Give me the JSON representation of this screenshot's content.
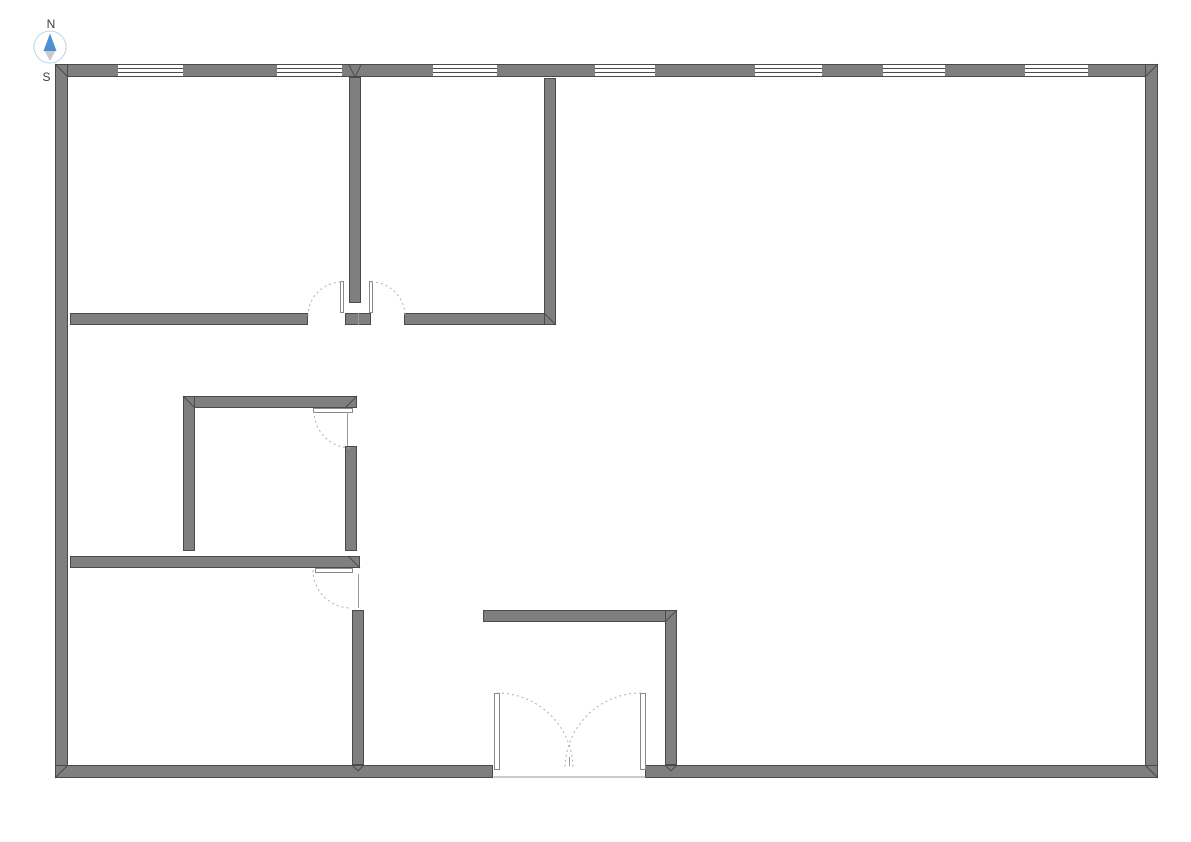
{
  "compass": {
    "north_label": "N",
    "south_label": "S",
    "ring_color": "#b5d6e8",
    "needle_north_color": "#4a90d2",
    "needle_south_color": "#c7cbd1",
    "label_color": "#3d3d3d",
    "cx": 50,
    "cy": 47,
    "r": 16
  },
  "plan": {
    "style": {
      "background": "#ffffff",
      "wall_fill": "#7f7f7f",
      "wall_stroke": "#4a4a4a",
      "window_fill": "#ffffff",
      "window_line": "#4a4a4a",
      "door_fill": "#ffffff",
      "door_stroke": "#8a8a8a",
      "arc_color": "#b0b0b0",
      "jamb_color": "#9a9a9a"
    },
    "walls": [
      {
        "id": "exterior-top",
        "x": 55,
        "y": 64,
        "w": 1103,
        "h": 13
      },
      {
        "id": "exterior-left",
        "x": 55,
        "y": 64,
        "w": 13,
        "h": 714
      },
      {
        "id": "exterior-right",
        "x": 1145,
        "y": 64,
        "w": 13,
        "h": 714
      },
      {
        "id": "exterior-bottom-west",
        "x": 55,
        "y": 765,
        "w": 438,
        "h": 13
      },
      {
        "id": "exterior-bottom-east",
        "x": 645,
        "y": 765,
        "w": 513,
        "h": 13
      },
      {
        "id": "interior-divider-top-rooms",
        "x": 349,
        "y": 77,
        "w": 12,
        "h": 226
      },
      {
        "id": "interior-door-stub",
        "x": 345,
        "y": 313,
        "w": 26,
        "h": 12
      },
      {
        "id": "interior-hall-west",
        "x": 70,
        "y": 313,
        "w": 238,
        "h": 12
      },
      {
        "id": "interior-hall-east",
        "x": 404,
        "y": 313,
        "w": 152,
        "h": 12
      },
      {
        "id": "interior-top-middle-room-east",
        "x": 544,
        "y": 78,
        "w": 12,
        "h": 247
      },
      {
        "id": "interior-small-room-north",
        "x": 183,
        "y": 396,
        "w": 174,
        "h": 12
      },
      {
        "id": "interior-small-room-west",
        "x": 183,
        "y": 396,
        "w": 12,
        "h": 155
      },
      {
        "id": "interior-small-room-east",
        "x": 345,
        "y": 446,
        "w": 12,
        "h": 105
      },
      {
        "id": "interior-lower-room-north",
        "x": 70,
        "y": 556,
        "w": 290,
        "h": 12
      },
      {
        "id": "interior-lower-room-east",
        "x": 352,
        "y": 610,
        "w": 12,
        "h": 155
      },
      {
        "id": "interior-entry-north",
        "x": 483,
        "y": 610,
        "w": 194,
        "h": 12
      },
      {
        "id": "interior-entry-east",
        "x": 665,
        "y": 610,
        "w": 12,
        "h": 155
      }
    ],
    "windows": [
      {
        "x": 118,
        "y": 64,
        "w": 65,
        "h": 13
      },
      {
        "x": 277,
        "y": 64,
        "w": 65,
        "h": 13
      },
      {
        "x": 433,
        "y": 64,
        "w": 64,
        "h": 13
      },
      {
        "x": 595,
        "y": 64,
        "w": 60,
        "h": 13
      },
      {
        "x": 755,
        "y": 64,
        "w": 67,
        "h": 13
      },
      {
        "x": 883,
        "y": 64,
        "w": 62,
        "h": 13
      },
      {
        "x": 1025,
        "y": 64,
        "w": 63,
        "h": 13
      }
    ],
    "door_leaves": [
      {
        "id": "double-interior-left-leaf",
        "x": 340,
        "y": 281,
        "w": 4,
        "h": 32
      },
      {
        "id": "double-interior-right-leaf",
        "x": 369,
        "y": 281,
        "w": 4,
        "h": 32
      },
      {
        "id": "small-room-door-leaf",
        "x": 313,
        "y": 408,
        "w": 40,
        "h": 5
      },
      {
        "id": "lower-room-door-leaf",
        "x": 315,
        "y": 568,
        "w": 38,
        "h": 5
      },
      {
        "id": "entry-door-left-leaf",
        "x": 494,
        "y": 693,
        "w": 6,
        "h": 77
      },
      {
        "id": "entry-door-right-leaf",
        "x": 640,
        "y": 693,
        "w": 6,
        "h": 77
      }
    ],
    "door_arcs": [
      {
        "x1": 308,
        "y1": 316,
        "x2": 342,
        "y2": 282,
        "r": 34,
        "sweep": 1
      },
      {
        "x1": 371,
        "y1": 282,
        "x2": 405,
        "y2": 316,
        "r": 34,
        "sweep": 1
      },
      {
        "x1": 314,
        "y1": 411,
        "x2": 351,
        "y2": 448,
        "r": 37,
        "sweep": 0
      },
      {
        "x1": 313,
        "y1": 570,
        "x2": 351,
        "y2": 608,
        "r": 38,
        "sweep": 0
      },
      {
        "x1": 497,
        "y1": 693,
        "x2": 573,
        "y2": 769,
        "r": 76,
        "sweep": 1
      },
      {
        "x1": 641,
        "y1": 693,
        "x2": 565,
        "y2": 769,
        "r": 76,
        "sweep": 0
      }
    ],
    "jamb_lines": [
      {
        "x1": 347,
        "y1": 413,
        "x2": 347,
        "y2": 446
      },
      {
        "x1": 358,
        "y1": 574,
        "x2": 358,
        "y2": 608
      },
      {
        "x1": 358,
        "y1": 313,
        "x2": 358,
        "y2": 325
      },
      {
        "x1": 493,
        "y1": 777,
        "x2": 645,
        "y2": 777
      },
      {
        "x1": 569,
        "y1": 757,
        "x2": 569,
        "y2": 766
      }
    ],
    "wall_joints": [
      {
        "x1": 55,
        "y1": 64,
        "x2": 68,
        "y2": 77
      },
      {
        "x1": 1158,
        "y1": 64,
        "x2": 1145,
        "y2": 77
      },
      {
        "x1": 55,
        "y1": 778,
        "x2": 68,
        "y2": 765
      },
      {
        "x1": 1158,
        "y1": 778,
        "x2": 1145,
        "y2": 765
      },
      {
        "x1": 183,
        "y1": 396,
        "x2": 195,
        "y2": 408
      },
      {
        "x1": 357,
        "y1": 396,
        "x2": 345,
        "y2": 408
      },
      {
        "x1": 556,
        "y1": 325,
        "x2": 544,
        "y2": 313
      },
      {
        "x1": 348,
        "y1": 556,
        "x2": 360,
        "y2": 568
      },
      {
        "x1": 677,
        "y1": 610,
        "x2": 665,
        "y2": 622
      },
      {
        "x1": 349,
        "y1": 65,
        "x2": 355,
        "y2": 77
      },
      {
        "x1": 361,
        "y1": 65,
        "x2": 355,
        "y2": 77
      },
      {
        "x1": 352,
        "y1": 765,
        "x2": 358,
        "y2": 771
      },
      {
        "x1": 364,
        "y1": 765,
        "x2": 358,
        "y2": 771
      },
      {
        "x1": 665,
        "y1": 765,
        "x2": 671,
        "y2": 771
      },
      {
        "x1": 677,
        "y1": 765,
        "x2": 671,
        "y2": 771
      }
    ]
  }
}
